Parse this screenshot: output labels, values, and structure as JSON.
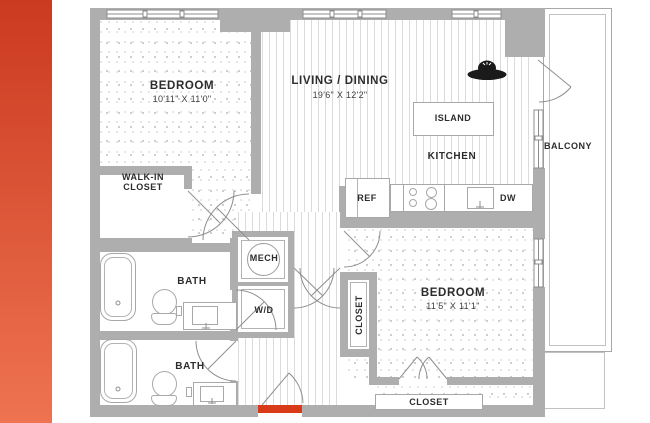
{
  "plan": {
    "rooms": {
      "bedroom1": {
        "label": "BEDROOM",
        "dims": "10'11\" X 11'0\""
      },
      "living_dining": {
        "label": "LIVING / DINING",
        "dims": "19'6\" X 12'2\""
      },
      "kitchen": {
        "label": "KITCHEN"
      },
      "bedroom2": {
        "label": "BEDROOM",
        "dims": "11'5\" X 11'1\""
      },
      "balcony": {
        "label": "BALCONY"
      },
      "walk_in_closet": {
        "label": "WALK-IN CLOSET"
      },
      "bath1": {
        "label": "BATH"
      },
      "bath2": {
        "label": "BATH"
      },
      "mech": {
        "label": "MECH"
      },
      "washer_dryer": {
        "label": "W/D"
      },
      "hall_closet": {
        "label": "CLOSET"
      },
      "bedroom2_closet": {
        "label": "CLOSET"
      }
    },
    "fixtures": {
      "refrigerator": {
        "label": "REF"
      },
      "dishwasher": {
        "label": "DW"
      },
      "island": {
        "label": "ISLAND"
      }
    },
    "colors": {
      "accent_bar_top": "#cb3a21",
      "accent_bar_bottom": "#ee7351",
      "entry_marker": "#d93a17",
      "wall": "#aeaeae",
      "label_text": "#2d2d2d"
    }
  }
}
